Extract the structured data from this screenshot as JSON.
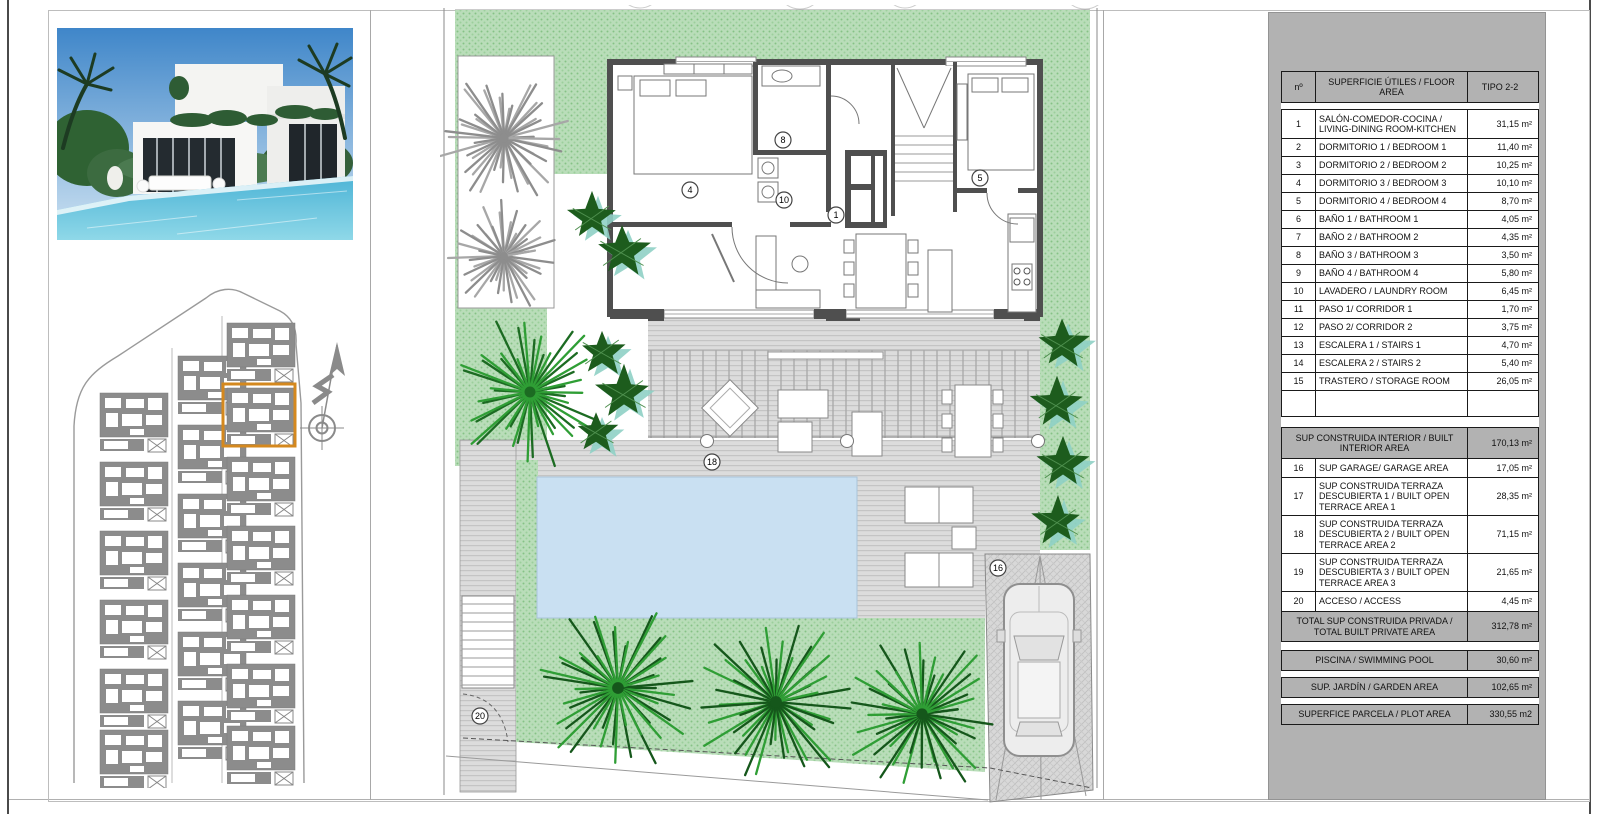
{
  "table": {
    "header": {
      "col_no": "nº",
      "col_desc": "SUPERFICIE ÚTILES / FLOOR AREA",
      "col_type": "TIPO 2-2"
    },
    "rows": [
      {
        "no": "1",
        "desc": "SALÓN-COMEDOR-COCINA / LIVING-DINING ROOM-KITCHEN",
        "value": "31,15 m²",
        "h": 28
      },
      {
        "no": "2",
        "desc": "DORMITORIO 1 / BEDROOM 1",
        "value": "11,40 m²",
        "h": 18
      },
      {
        "no": "3",
        "desc": "DORMITORIO 2 / BEDROOM 2",
        "value": "10,25 m²",
        "h": 18
      },
      {
        "no": "4",
        "desc": "DORMITORIO 3 / BEDROOM 3",
        "value": "10,10 m²",
        "h": 18
      },
      {
        "no": "5",
        "desc": "DORMITORIO 4 / BEDROOM 4",
        "value": "8,70 m²",
        "h": 18
      },
      {
        "no": "6",
        "desc": "BAÑO 1 / BATHROOM 1",
        "value": "4,05 m²",
        "h": 18
      },
      {
        "no": "7",
        "desc": "BAÑO 2 / BATHROOM 2",
        "value": "4,35 m²",
        "h": 18
      },
      {
        "no": "8",
        "desc": "BAÑO 3 / BATHROOM 3",
        "value": "3,50 m²",
        "h": 18
      },
      {
        "no": "9",
        "desc": "BAÑO 4 / BATHROOM 4",
        "value": "5,80 m²",
        "h": 18
      },
      {
        "no": "10",
        "desc": "LAVADERO / LAUNDRY ROOM",
        "value": "6,45 m²",
        "h": 18
      },
      {
        "no": "11",
        "desc": "PASO 1/ CORRIDOR 1",
        "value": "1,70 m²",
        "h": 18
      },
      {
        "no": "12",
        "desc": "PASO 2/ CORRIDOR 2",
        "value": "3,75 m²",
        "h": 18
      },
      {
        "no": "13",
        "desc": "ESCALERA 1 / STAIRS 1",
        "value": "4,70 m²",
        "h": 18
      },
      {
        "no": "14",
        "desc": "ESCALERA 2 / STAIRS 2",
        "value": "5,40 m²",
        "h": 18
      },
      {
        "no": "15",
        "desc": "TRASTERO / STORAGE ROOM",
        "value": "26,05 m²",
        "h": 18
      }
    ],
    "built_interior": {
      "desc": "SUP CONSTRUIDA INTERIOR / BUILT INTERIOR AREA",
      "value": "170,13 m²"
    },
    "rows2": [
      {
        "no": "16",
        "desc": "SUP GARAGE/ GARAGE AREA",
        "value": "17,05 m²",
        "h": 19
      },
      {
        "no": "17",
        "desc": "SUP CONSTRUIDA TERRAZA DESCUBIERTA 1 / BUILT OPEN TERRACE AREA 1",
        "value": "28,35 m²",
        "h": 38
      },
      {
        "no": "18",
        "desc": "SUP CONSTRUIDA TERRAZA DESCUBIERTA 2 / BUILT OPEN TERRACE AREA 2",
        "value": "71,15 m²",
        "h": 38
      },
      {
        "no": "19",
        "desc": "SUP CONSTRUIDA TERRAZA DESCUBIERTA 3 / BUILT OPEN TERRACE AREA 3",
        "value": "21,65 m²",
        "h": 38
      },
      {
        "no": "20",
        "desc": "ACCESO / ACCESS",
        "value": "4,45 m²",
        "h": 20
      }
    ],
    "total_private": {
      "desc": "TOTAL SUP CONSTRUIDA PRIVADA / TOTAL BUILT PRIVATE AREA",
      "value": "312,78 m²"
    },
    "pool_row": {
      "desc": "PISCINA / SWIMMING POOL",
      "value": "30,60 m²"
    },
    "garden_row": {
      "desc": "SUP. JARDÍN / GARDEN AREA",
      "value": "102,65 m²"
    },
    "plot_row": {
      "desc": "SUPERFICE PARCELA / PLOT AREA",
      "value": "330,55 m2"
    }
  },
  "plan_labels": {
    "living": "1",
    "bed4": "4",
    "bed5": "5",
    "bath3": "8",
    "laundry": "10",
    "garage": "16",
    "terrace2": "18",
    "access": "20"
  },
  "colors": {
    "panel_gray": "#b2b2b2",
    "garden_green": "#b9ddb9",
    "garden_dot": "#86c286",
    "pool_blue": "#c9e0f2",
    "deck_gray": "#dcdcdc",
    "wall_gray": "#4f4f4f",
    "tree_green": "#2f9e35",
    "bush_green": "#1d5c1d",
    "bush_teal": "#8fd0c5",
    "highlight_orange": "#d4881e",
    "keyplan_gray": "#8c8c8c"
  }
}
